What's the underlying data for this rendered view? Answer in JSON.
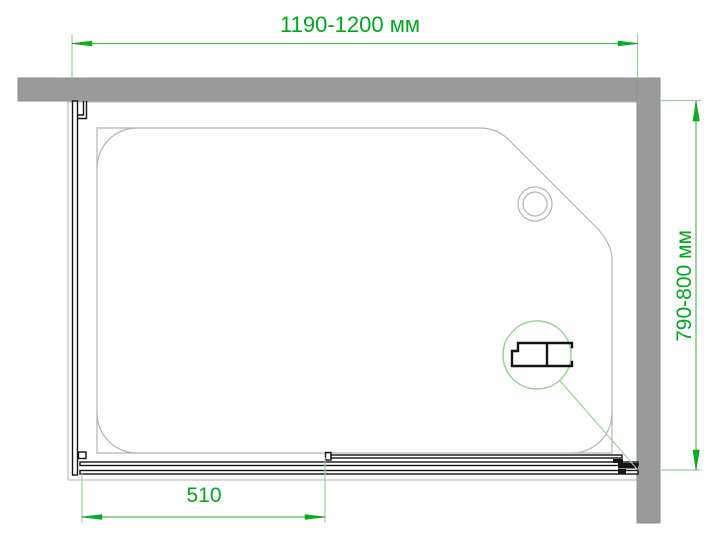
{
  "labels": {
    "width": "1190-1200 мм",
    "depth": "790-800 мм",
    "fixed_segment": "510"
  },
  "colors": {
    "dimension_text": "#00a81e",
    "dimension_line": "#58b758",
    "arrow": "#00b41e",
    "extension_line": "#9ccf9c",
    "wall": "#9a9a9a",
    "tray_outline": "#c8c8c8",
    "basin_outline": "#b4b4b4",
    "profile": "#141414"
  }
}
